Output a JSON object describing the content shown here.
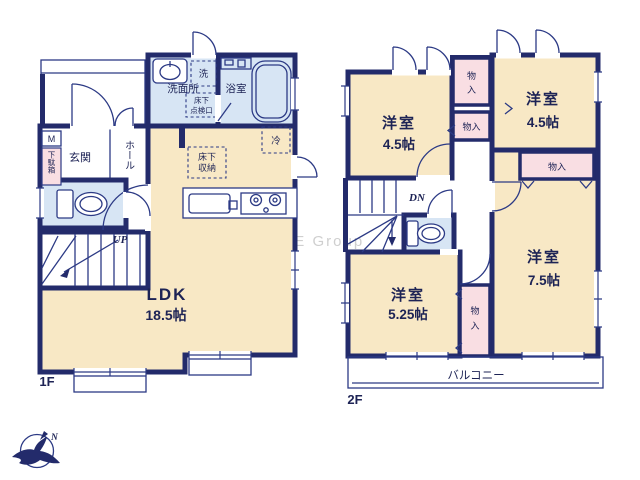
{
  "watermark": "ME Group",
  "compass": {
    "north": "N"
  },
  "floor1": {
    "label": "1F",
    "ldk": {
      "name": "LDK",
      "area": "18.5帖"
    },
    "entrance": "玄関",
    "hall": "ホール",
    "washroom": "洗面所",
    "bathroom": "浴室",
    "laundry": "洗",
    "floor_hatch": {
      "line1": "床下",
      "line2": "点検口"
    },
    "floor_storage": {
      "line1": "床下",
      "line2": "収納"
    },
    "fridge": "冷",
    "meter_box": "M",
    "shoe_box": "下駄箱",
    "stairs": "UP"
  },
  "floor2": {
    "label": "2F",
    "room_nw": {
      "name": "洋室",
      "area": "4.5帖"
    },
    "room_ne": {
      "name": "洋室",
      "area": "4.5帖"
    },
    "room_sw": {
      "name": "洋室",
      "area": "5.25帖"
    },
    "room_se": {
      "name": "洋室",
      "area": "7.5帖"
    },
    "closet_a": {
      "line1": "物",
      "line2": "入"
    },
    "closet_b": "物入",
    "closet_c": "物入",
    "closet_d": {
      "line1": "物",
      "line2": "入"
    },
    "stairs": "DN",
    "balcony": "バルコニー"
  }
}
